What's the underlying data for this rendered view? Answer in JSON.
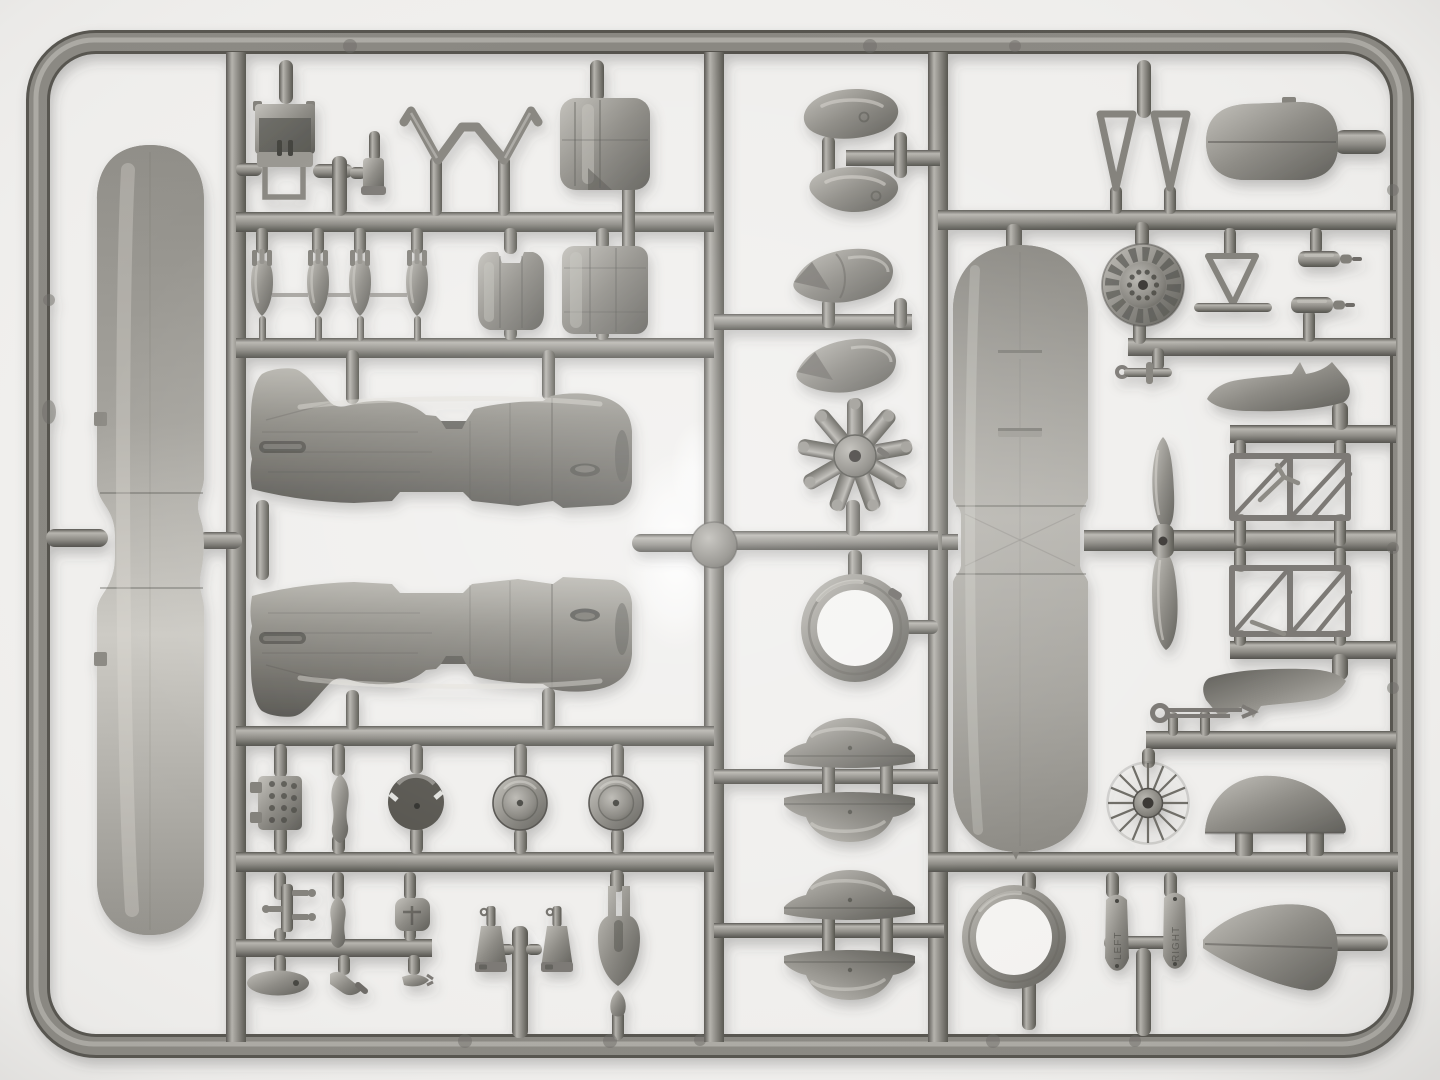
{
  "meta": {
    "title": "Gray plastic model-kit sprue with aircraft parts",
    "description": "Top-down photograph of a gray polystyrene injection-molded sprue (parts tree) from a biplane floatplane model kit. The rounded rectangular runner frame holds a one-piece lower wing, a one-piece upper wing, two fuselage halves, a 9-cylinder radial engine, cowling ring and panels, a two-blade propeller, wheels, wheel-spat halves, corrugated tail surfaces, strut trusses, bombs and many small fittings, photographed on a white lightbox.",
    "material": "gray polystyrene plastic",
    "background_surface": "white lightbox"
  },
  "palette": {
    "background": "#f0efed",
    "background_center": "#fcfcfb",
    "runner_dark": "#55544f",
    "runner_base": "#8a8882",
    "runner_light": "#bbb9b3",
    "part_dark": "#54534e",
    "part_base": "#8d8b85",
    "part_light": "#c9c7c1",
    "fuselage_dark": "#565550",
    "fuselage_light": "#b7b5ae",
    "shadow": "#45443f"
  },
  "engravings": {
    "left_paddle": "LEFT",
    "right_paddle": "RIGHT"
  },
  "parts_inventory": [
    "one-piece lower biplane wing",
    "one-piece upper biplane wing",
    "right fuselage half",
    "left fuselage half",
    "two-blade propeller",
    "9-cylinder radial engine",
    "engine cowling ring",
    "louvered engine front plate",
    "engine cowling half x2",
    "cowling front section",
    "spinner / fairing half x4",
    "wheel-spat half x4",
    "main wheel x2",
    "wire-spoked tail wheel",
    "corrugated tailplane",
    "corrugated fin halves",
    "corrugated cowling top panel",
    "small bomb x4",
    "float strut truss x2",
    "float fairing boot x2",
    "cabane V-strut x2",
    "W-shaped bracing frame",
    "pilot seat",
    "headrest dome",
    "accessory block",
    "machine gun x2",
    "tail-skid fork",
    "exhaust stubs and small fittings",
    "rigging paddles LEFT / RIGHT"
  ]
}
